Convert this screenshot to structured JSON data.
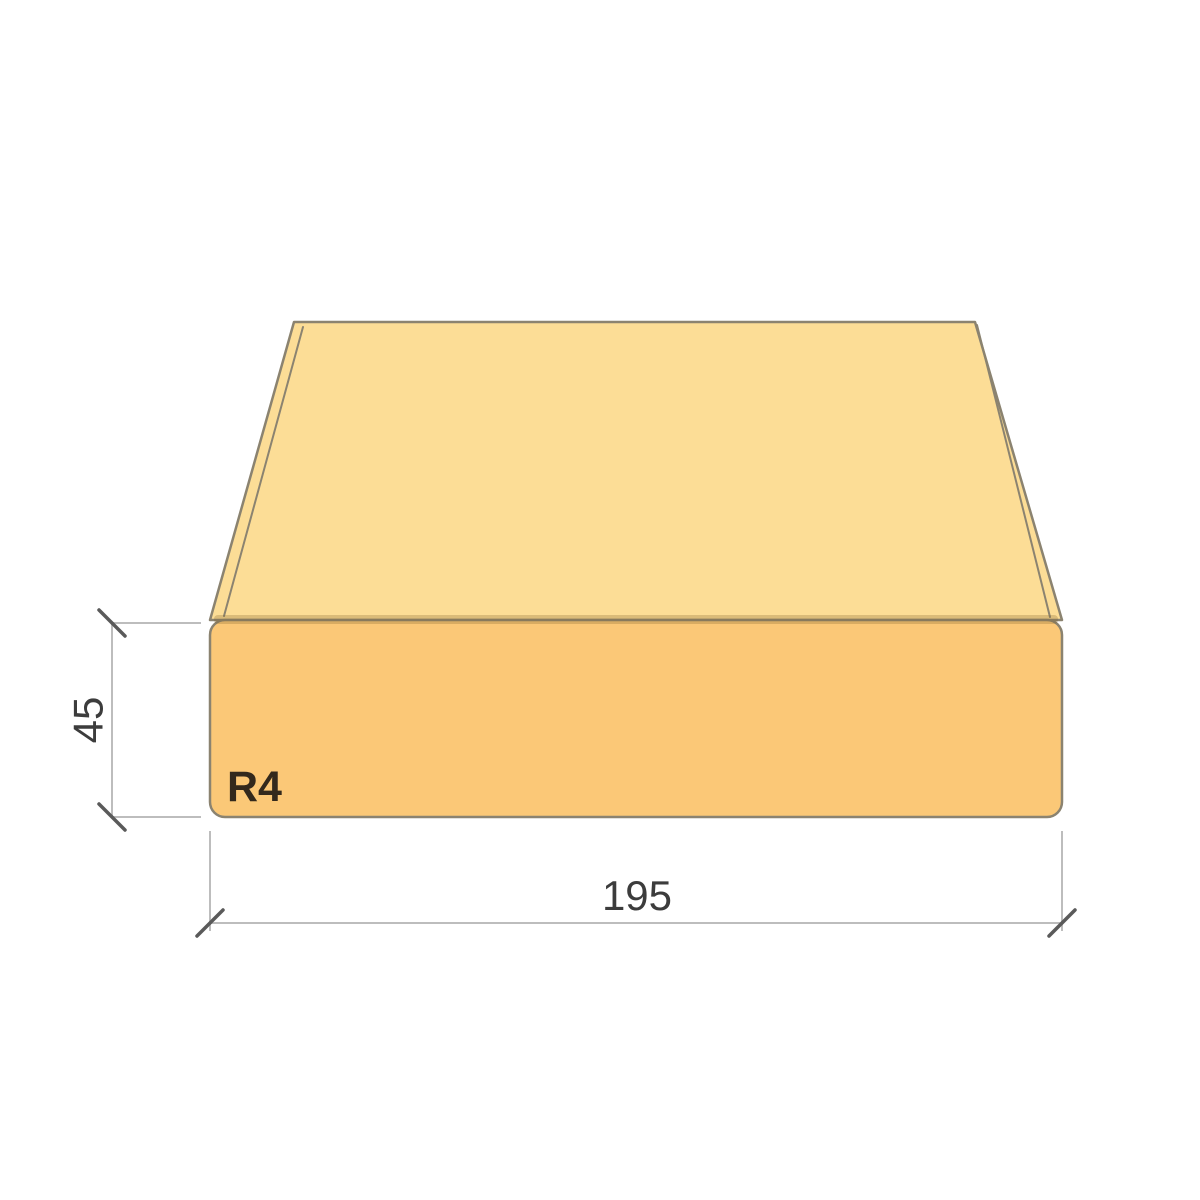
{
  "labels": {
    "height": "45",
    "width": "195",
    "corner_radius": "R4"
  },
  "colors": {
    "background": "#FFFFFF",
    "top_face": "#FCDD96",
    "front_face": "#FBC877",
    "edge_strip": "#F7D384",
    "outline": "#8B8370",
    "edge_shade": "rgba(130,100,45,0.28)",
    "dim_line": "#BDBDBD",
    "tick": "#5A5A5A",
    "dim_text": "#3C3C3C",
    "radius_text": "#33291C"
  }
}
